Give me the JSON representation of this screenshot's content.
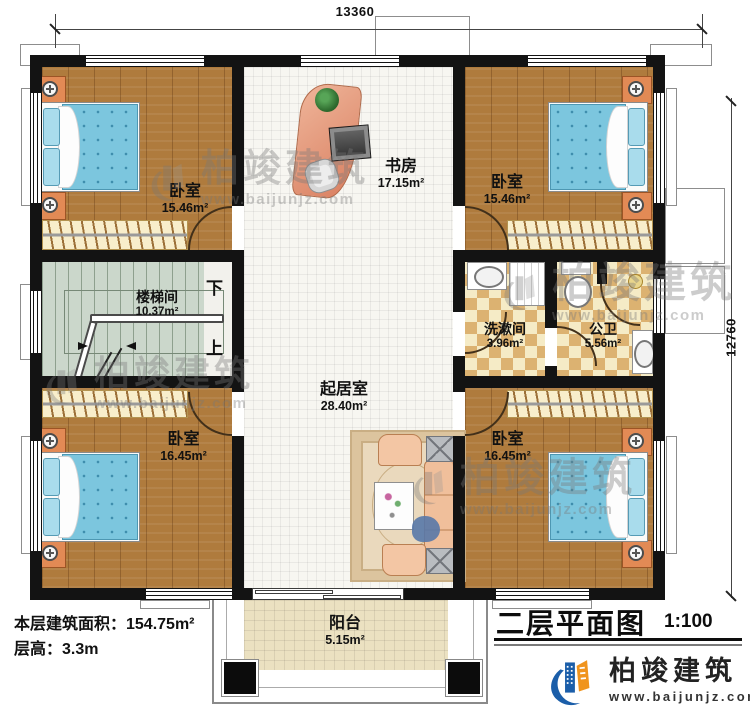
{
  "drawing": {
    "dimensions": {
      "width_mm": "13360",
      "height_mm": "12760"
    },
    "rooms": {
      "bedroom_tl": {
        "label": "卧室",
        "area": "15.46m²"
      },
      "study": {
        "label": "书房",
        "area": "17.15m²"
      },
      "bedroom_tr": {
        "label": "卧室",
        "area": "15.46m²"
      },
      "stairwell": {
        "label": "楼梯间",
        "area": "10.37m²"
      },
      "washroom": {
        "label": "洗漱间",
        "area": "3.96m²"
      },
      "toilet": {
        "label": "公卫",
        "area": "5.56m²"
      },
      "living": {
        "label": "起居室",
        "area": "28.40m²"
      },
      "bedroom_bl": {
        "label": "卧室",
        "area": "16.45m²"
      },
      "bedroom_br": {
        "label": "卧室",
        "area": "16.45m²"
      },
      "balcony": {
        "label": "阳台",
        "area": "5.15m²"
      }
    },
    "stairs": {
      "down": "下",
      "up": "上"
    },
    "notes": {
      "floor_area": "本层建筑面积：154.75m²",
      "floor_height": "层高：3.3m"
    },
    "titleblock": {
      "title": "二层平面图",
      "scale": "1:100"
    },
    "brand": {
      "name": "柏竣建筑",
      "url": "www.baijunjz.com"
    },
    "watermark": {
      "name": "柏竣建筑",
      "url": "www.baijunjz.com"
    },
    "colors": {
      "brand_blue": "#1b5ea9",
      "brand_orange": "#f0941d",
      "wall": "#131313",
      "wood_floor": "#af7b3d",
      "bed_blue": "#7cc6de",
      "tile_checker": "#dcb271"
    }
  }
}
